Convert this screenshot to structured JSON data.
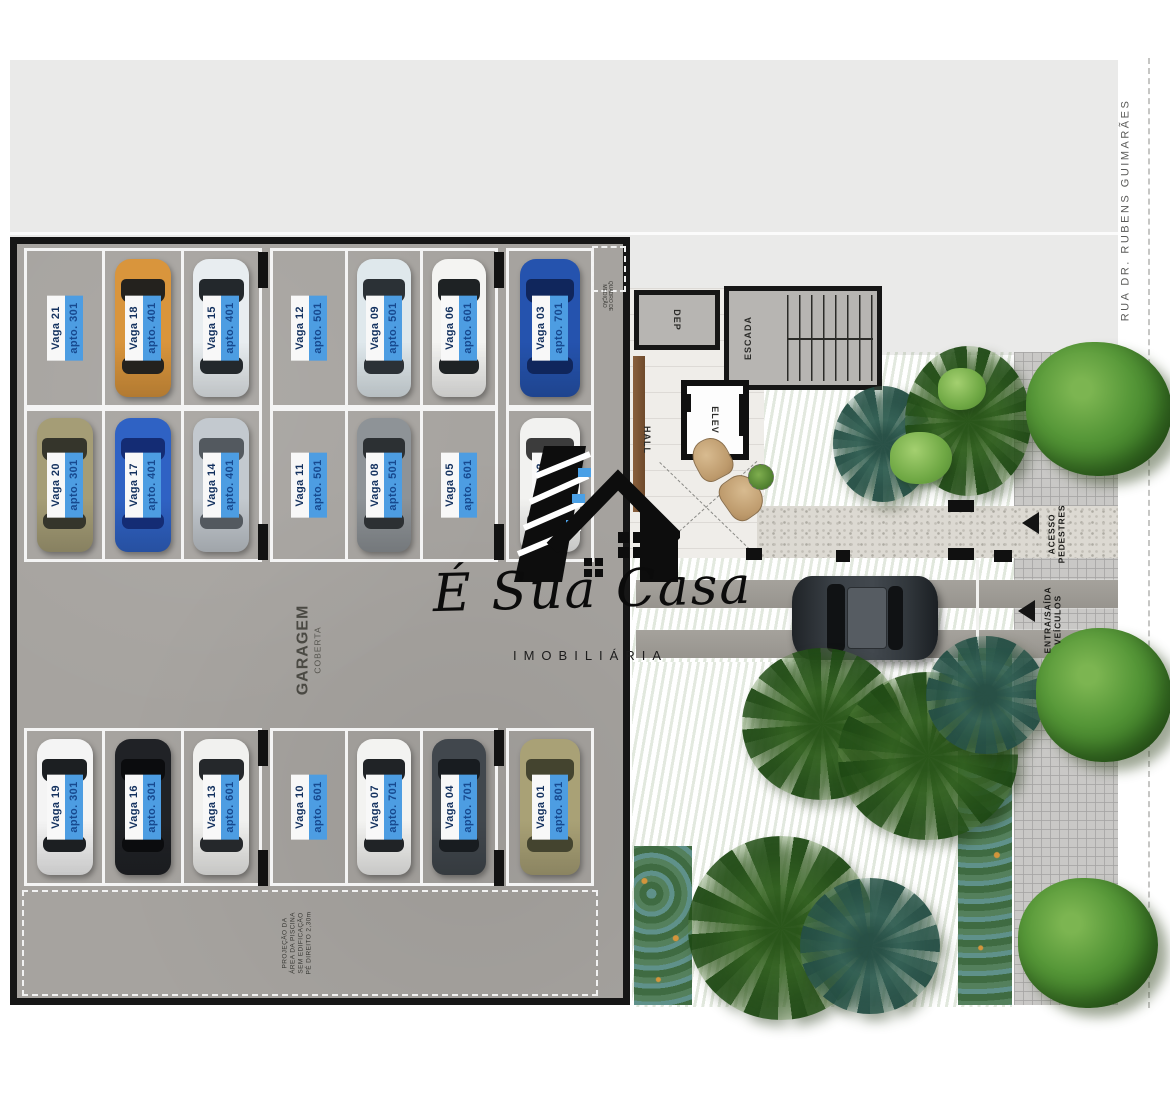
{
  "street_label": "RUA DR. RUBENS GUIMARÃES",
  "logo": {
    "title": "É Sua Casa",
    "subtitle": "IMOBILIÁRIA"
  },
  "garage": {
    "title": "GARAGEM",
    "subtitle": "COBERTA",
    "corner_note_lines": [
      "QUADRO DE",
      "MEDIÇÃO"
    ],
    "projection_note_lines": [
      "PROJEÇÃO DA",
      "ÁREA DA PISCINA",
      "SEM EDIFICAÇÃO",
      "PÉ DIREITO 2,30m"
    ],
    "spots": [
      {
        "vaga": "Vaga 21",
        "apto": "apto. 301",
        "group": "A1",
        "car": null
      },
      {
        "vaga": "Vaga 18",
        "apto": "apto. 401",
        "group": "A1",
        "car": "#d9953c",
        "glass": "#24221e"
      },
      {
        "vaga": "Vaga 15",
        "apto": "apto. 401",
        "group": "A1",
        "car": "#e8edf0",
        "glass": "#23282c"
      },
      {
        "vaga": "Vaga 12",
        "apto": "apto. 501",
        "group": "A2",
        "car": null
      },
      {
        "vaga": "Vaga 09",
        "apto": "apto. 501",
        "group": "A2",
        "car": "#dfe8ec",
        "glass": "#2b3136"
      },
      {
        "vaga": "Vaga 06",
        "apto": "apto. 601",
        "group": "A2",
        "car": "#f4f4f2",
        "glass": "#1e2224"
      },
      {
        "vaga": "Vaga 03",
        "apto": "apto. 701",
        "group": "A3",
        "car": "#2553ae",
        "glass": "#10265c"
      },
      {
        "vaga": "Vaga 20",
        "apto": "apto. 301",
        "group": "B1",
        "car": "#a59d76",
        "glass": "#35352b"
      },
      {
        "vaga": "Vaga 17",
        "apto": "apto. 401",
        "group": "B1",
        "car": "#2f62c4",
        "glass": "#142c74"
      },
      {
        "vaga": "Vaga 14",
        "apto": "apto. 401",
        "group": "B1",
        "car": "#c3c9cf",
        "glass": "#53595f"
      },
      {
        "vaga": "Vaga 11",
        "apto": "apto. 501",
        "group": "B2",
        "car": null
      },
      {
        "vaga": "Vaga 08",
        "apto": "apto. 501",
        "group": "B2",
        "car": "#8e9397",
        "glass": "#2c3033"
      },
      {
        "vaga": "Vaga 05",
        "apto": "apto. 601",
        "group": "B2",
        "car": null
      },
      {
        "vaga": "Vaga 02",
        "apto": "apto. 801",
        "group": "B3",
        "car": "#f2f2f0",
        "glass": "#3c3c3c"
      },
      {
        "vaga": "Vaga 19",
        "apto": "apto. 301",
        "group": "C1",
        "car": "#f4f4f4",
        "glass": "#1c1f22"
      },
      {
        "vaga": "Vaga 16",
        "apto": "apto. 301",
        "group": "C1",
        "car": "#202226",
        "glass": "#0b0c0e"
      },
      {
        "vaga": "Vaga 13",
        "apto": "apto. 601",
        "group": "C1",
        "car": "#f1f1ef",
        "glass": "#25282b"
      },
      {
        "vaga": "Vaga 10",
        "apto": "apto. 601",
        "group": "C2",
        "car": null
      },
      {
        "vaga": "Vaga 07",
        "apto": "apto. 701",
        "group": "C2",
        "car": "#f3f3f1",
        "glass": "#202326"
      },
      {
        "vaga": "Vaga 04",
        "apto": "apto. 701",
        "group": "C2",
        "car": "#41474d",
        "glass": "#181c20"
      },
      {
        "vaga": "Vaga 01",
        "apto": "apto. 801",
        "group": "C3",
        "car": "#a9a176",
        "glass": "#44442f"
      }
    ]
  },
  "building": {
    "dep": "DEP",
    "escada": "ESCADA",
    "hall": "HALL",
    "elev": "ELEV"
  },
  "access": {
    "pedestrian_lines": [
      "ACESSO",
      "PEDESTRES"
    ],
    "vehicle_lines": [
      "ENTRA/SAÍDA",
      "VEÍCULOS"
    ]
  },
  "colors": {
    "label_blue": "#4d9de2",
    "label_text": "#17498f",
    "wall_black": "#161616"
  }
}
